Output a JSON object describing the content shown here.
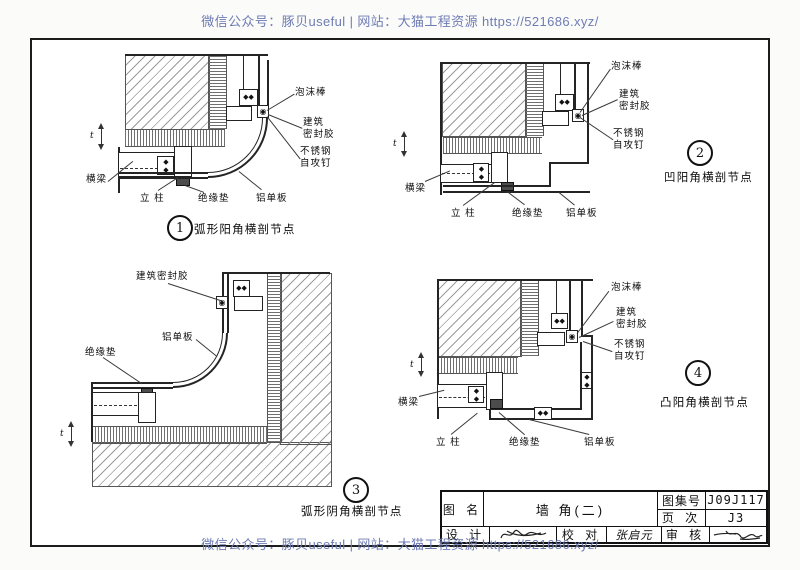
{
  "watermark": {
    "text": "微信公众号：豚贝useful | 网站：大猫工程资源 https://521686.xyz/",
    "color": "#6e7cb4"
  },
  "icons": {
    "fastener": "◆◆",
    "joint": "◉"
  },
  "common": {
    "dim": "t"
  },
  "details": [
    {
      "number": "1",
      "caption": "弧形阳角横剖节点",
      "labels": {
        "foam": "泡沫棒",
        "sealant1": "建筑",
        "sealant2": "密封胶",
        "screw1": "不锈钢",
        "screw2": "自攻钉",
        "beam": "横梁",
        "column": "立 柱",
        "pad": "绝缘垫",
        "panel": "铝单板"
      }
    },
    {
      "number": "2",
      "caption": "凹阳角横剖节点",
      "labels": {
        "foam": "泡沫棒",
        "sealant1": "建筑",
        "sealant2": "密封胶",
        "screw1": "不锈钢",
        "screw2": "自攻钉",
        "beam": "横梁",
        "column": "立 柱",
        "pad": "绝缘垫",
        "panel": "铝单板"
      }
    },
    {
      "number": "3",
      "caption": "弧形阴角横剖节点",
      "labels": {
        "sealant": "建筑密封胶",
        "panel": "铝单板",
        "pad": "绝缘垫"
      }
    },
    {
      "number": "4",
      "caption": "凸阳角横剖节点",
      "labels": {
        "foam": "泡沫棒",
        "sealant1": "建筑",
        "sealant2": "密封胶",
        "screw1": "不锈钢",
        "screw2": "自攻钉",
        "beam": "横梁",
        "column": "立 柱",
        "pad": "绝缘垫",
        "panel": "铝单板"
      }
    }
  ],
  "title_block": {
    "name_label": "图 名",
    "name_value": "墙 角(二)",
    "set_label": "图集号",
    "set_value": "J09J117",
    "page_label": "页 次",
    "page_value": "J3",
    "design_label": "设 计",
    "proof_label": "校 对",
    "proof_name": "张启元",
    "review_label": "审 核"
  }
}
